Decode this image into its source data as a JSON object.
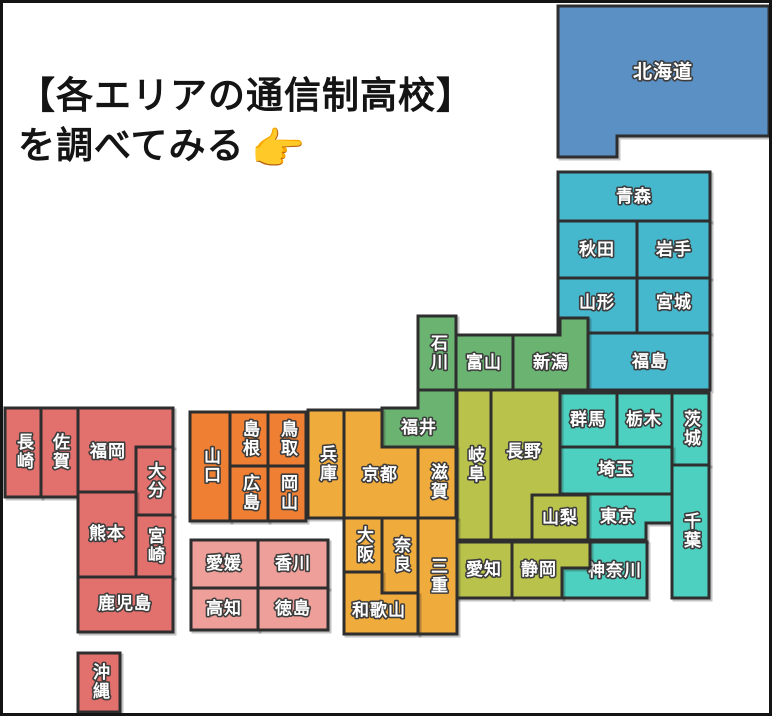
{
  "title": {
    "line1": "【各エリアの通信制高校】",
    "line2": "を調べてみる",
    "pointer_emoji": "👉"
  },
  "map": {
    "colors": {
      "hokkaido": "#5b90c4",
      "tohoku": "#45b8ce",
      "hokuriku_koshinetsu": "#6bb371",
      "kanto": "#4ed0c0",
      "chubu_tokai": "#b9c24a",
      "kansai": "#f0ab3d",
      "chugoku": "#ee7f33",
      "shikoku": "#ef9f9a",
      "kyushu_okinawa": "#e2706d"
    },
    "prefectures": [
      "北海道",
      "青森",
      "秋田",
      "岩手",
      "山形",
      "宮城",
      "福島",
      "新潟",
      "富山",
      "石川",
      "福井",
      "群馬",
      "栃木",
      "茨城",
      "埼玉",
      "東京",
      "千葉",
      "神奈川",
      "長野",
      "山梨",
      "岐阜",
      "愛知",
      "静岡",
      "京都",
      "滋賀",
      "兵庫",
      "大阪",
      "奈良",
      "三重",
      "和歌山",
      "鳥取",
      "島根",
      "岡山",
      "広島",
      "山口",
      "愛媛",
      "香川",
      "高知",
      "徳島",
      "長崎",
      "佐賀",
      "福岡",
      "大分",
      "熊本",
      "宮崎",
      "鹿児島",
      "沖縄"
    ]
  }
}
